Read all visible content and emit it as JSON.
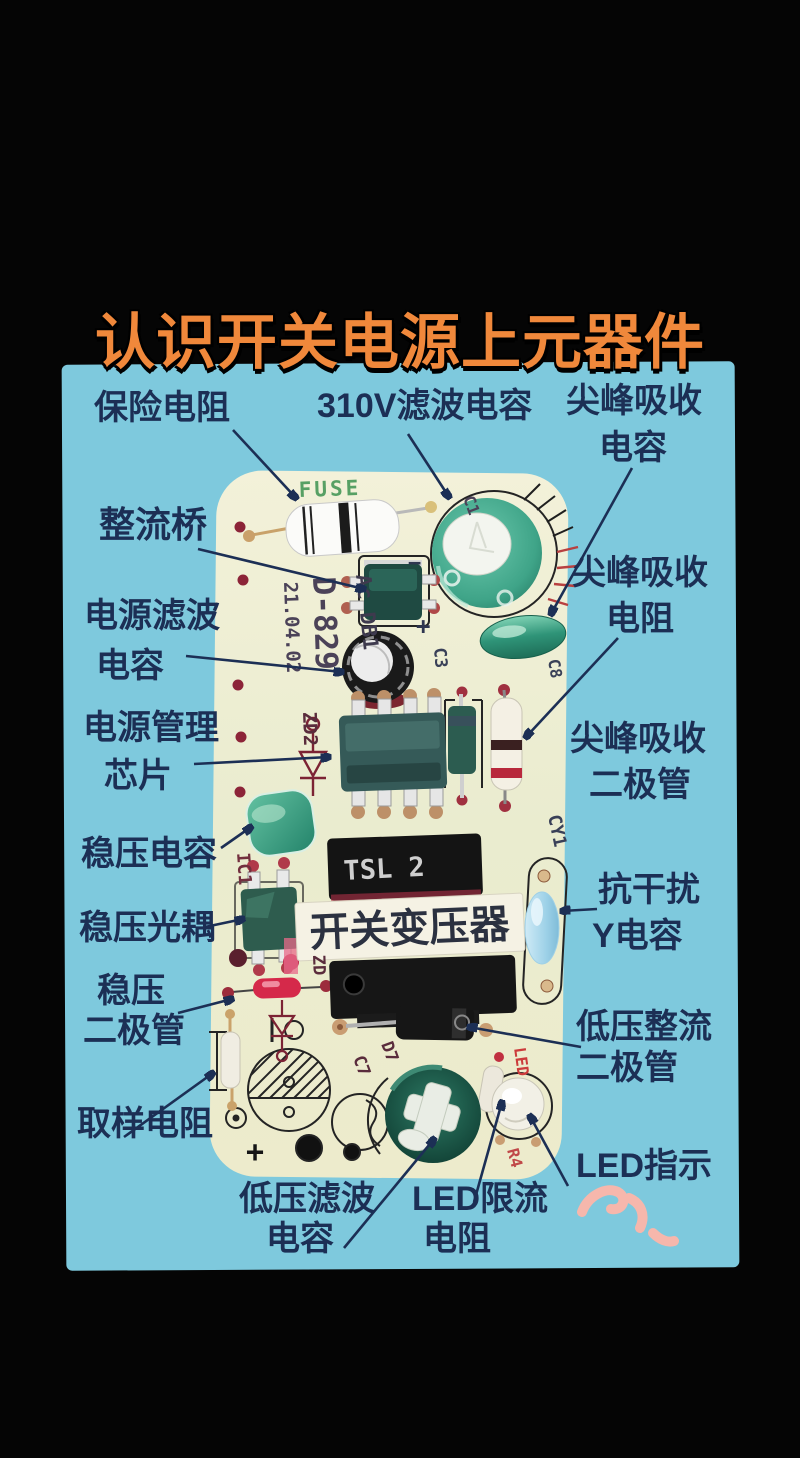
{
  "title": "认识开关电源上元器件",
  "annotations": {
    "fuse_resistor": "保险电阻",
    "cap_310v": "310V滤波电容",
    "spike_cap_1": "尖峰吸收",
    "spike_cap_2": "电容",
    "rectifier_bridge": "整流桥",
    "spike_res_1": "尖峰吸收",
    "spike_res_2": "电阻",
    "power_filter_1": "电源滤波",
    "power_filter_2": "电容",
    "pm_chip_1": "电源管理",
    "pm_chip_2": "芯片",
    "spike_diode_1": "尖峰吸收",
    "spike_diode_2": "二极管",
    "reg_cap": "稳压电容",
    "y_cap_1": "抗干扰",
    "y_cap_2": "Y电容",
    "reg_opto": "稳压光耦",
    "reg_diode_1": "稳压",
    "reg_diode_2": "二极管",
    "lv_rect_1": "低压整流",
    "lv_rect_2": "二极管",
    "sampling_res": "取样电阻",
    "led_ind": "LED指示",
    "lv_filter_1": "低压滤波",
    "lv_filter_2": "电容",
    "led_res_1": "LED限流",
    "led_res_2": "电阻"
  },
  "pcb": {
    "transformer_label": "开关变压器",
    "transformer_marking": "TSL 2",
    "silkscreen": {
      "fuse": "FUSE",
      "model": "D-829",
      "date": "21.04.02",
      "ac_db1": "Ac DB1",
      "zd2": "ZD2",
      "ic1": "IC1",
      "zd": "ZD",
      "cy1": "CY1",
      "c1": "C1",
      "c3": "C3",
      "c8": "C8",
      "c7": "C7",
      "d7": "D7",
      "led": "LED",
      "r4": "R4",
      "plus_bridge": "+",
      "minus_bridge": "−",
      "plus_out": "+"
    }
  },
  "colors": {
    "title_orange": "#f0883b",
    "panel_blue": "#7ec9dd",
    "label_navy": "#1c2f55",
    "pcb_cream": "#edeed3",
    "component_teal": "#3aa183",
    "squiggle_pink": "#f6b7ac"
  }
}
